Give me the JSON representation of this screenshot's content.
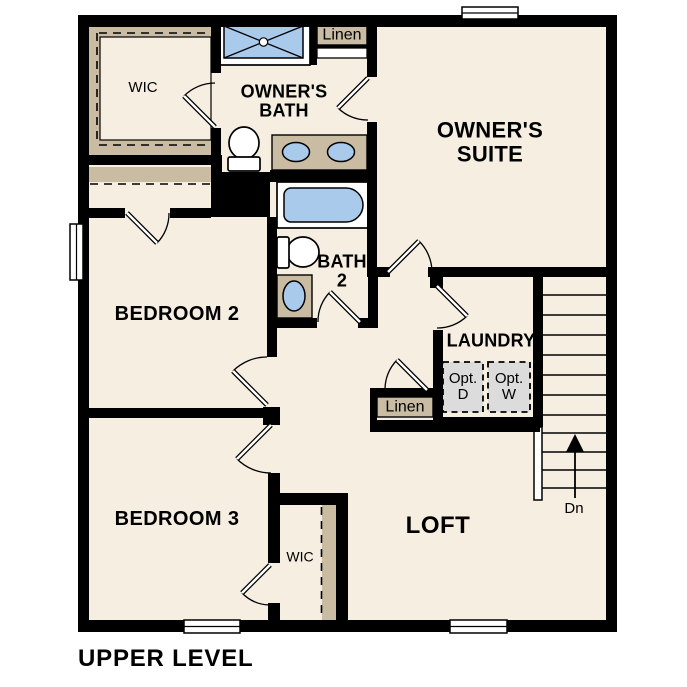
{
  "title": "UPPER LEVEL",
  "colors": {
    "floor": "#F5EEE1",
    "wall": "#000000",
    "shelf": "#C9BCA3",
    "fixture_blue": "#A9CAEB",
    "appliance_gray": "#DCDCDC"
  },
  "rooms": {
    "owners_suite": {
      "line1": "OWNER'S",
      "line2": "SUITE"
    },
    "owners_bath": {
      "line1": "OWNER'S",
      "line2": "BATH"
    },
    "owners_wic": {
      "label": "WIC"
    },
    "linen_upper": {
      "label": "Linen"
    },
    "bath2": {
      "line1": "BATH",
      "line2": "2"
    },
    "bedroom2": {
      "label": "BEDROOM 2"
    },
    "laundry": {
      "label": "LAUNDRY"
    },
    "linen_hall": {
      "label": "Linen"
    },
    "bedroom3": {
      "label": "BEDROOM 3"
    },
    "bedroom3_wic": {
      "label": "WIC"
    },
    "loft": {
      "label": "LOFT"
    }
  },
  "appliances": {
    "opt_dryer": {
      "line1": "Opt.",
      "line2": "D"
    },
    "opt_washer": {
      "line1": "Opt.",
      "line2": "W"
    }
  },
  "stairs": {
    "down_label": "Dn"
  },
  "fixtures": [
    "shower",
    "double-vanity",
    "toilet",
    "bathtub",
    "single-vanity",
    "optional-dryer",
    "optional-washer",
    "stairs",
    "railing",
    "windows",
    "doors"
  ]
}
